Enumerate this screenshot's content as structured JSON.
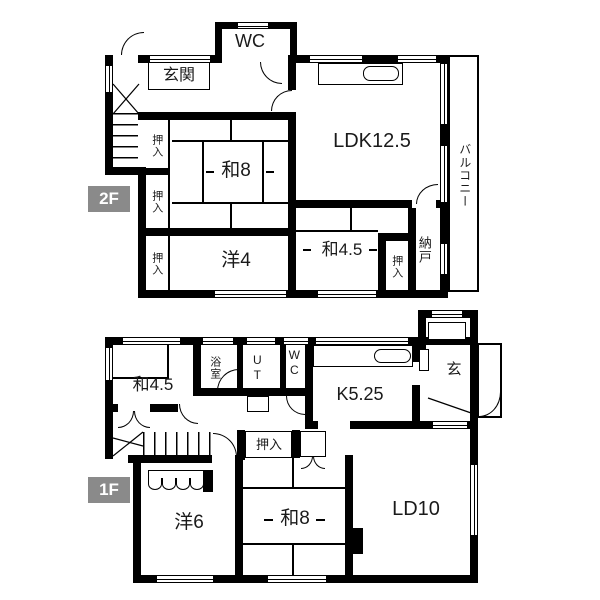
{
  "floors": [
    {
      "badge": "2F",
      "rooms": {
        "wc": "WC",
        "genkan": "玄関",
        "ldk": "LDK12.5",
        "wa8": "和8",
        "yo4": "洋4",
        "wa45": "和4.5",
        "oshiire_a": "押入",
        "oshiire_b": "押入",
        "oshiire_c": "押入",
        "oshiire_d": "押入",
        "nando": "納戸",
        "balcony": "バルコニー"
      }
    },
    {
      "badge": "1F",
      "rooms": {
        "wa45": "和4.5",
        "bath": "浴室",
        "ut": "UT",
        "wc": "WC",
        "kitchen": "K5.25",
        "genkan": "玄",
        "oshiire": "押入",
        "yo6": "洋6",
        "wa8": "和8",
        "ld": "LD10"
      }
    }
  ],
  "colors": {
    "wall": "#000000",
    "background": "#ffffff",
    "line": "#1a1a1a",
    "badge_bg": "#8a8a8a",
    "badge_text": "#ffffff"
  }
}
